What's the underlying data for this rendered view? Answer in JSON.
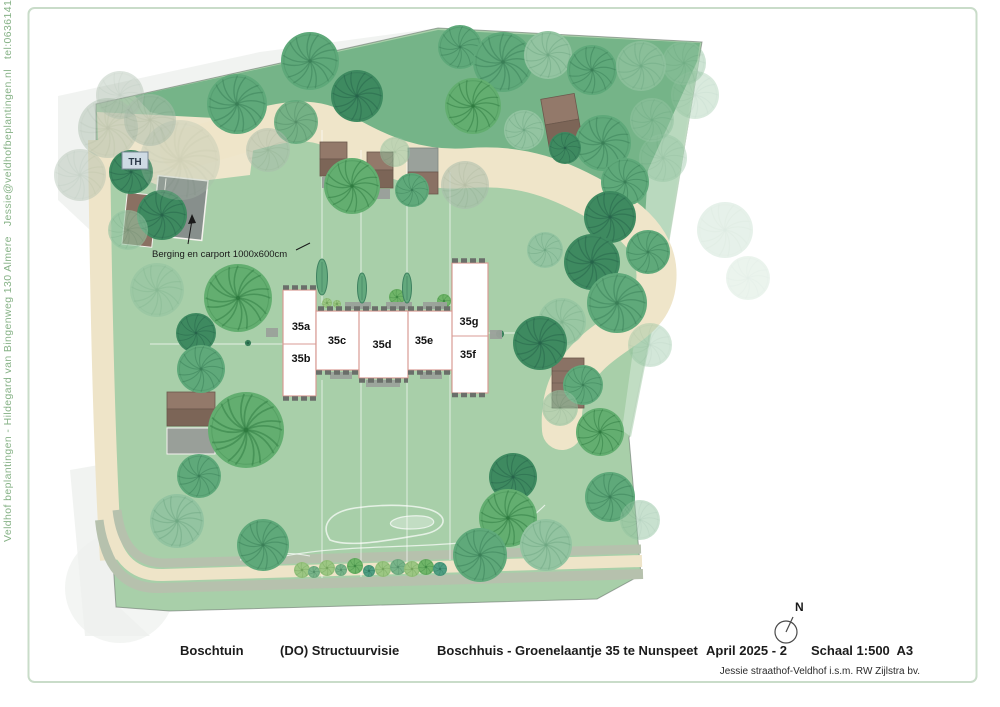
{
  "page": {
    "frame_color": "#c9dcc9",
    "background": "#ffffff"
  },
  "sidebar": {
    "text": "Veldhof beplantingen - Hildegard van Bingenweg 130 Almere   Jessie@veldhofbeplantingen.nl   tel:0636141206",
    "color": "#86b286"
  },
  "footer": {
    "project": "Boschtuin",
    "phase": "(DO) Structuurvisie",
    "title": "Boschhuis - Groenelaantje 35 te Nunspeet",
    "date": "April 2025 - 2",
    "scale": "Schaal 1:500  A3",
    "credit": "Jessie straathof-Veldhof i.s.m. RW Zijlstra bv."
  },
  "compass": {
    "label": "N"
  },
  "map": {
    "annotations": {
      "th_label": "TH",
      "berging_label": "Berging en carport 1000x600cm"
    },
    "colors": {
      "lawn": "#a8cfa9",
      "dark_band": "#75b488",
      "path_beige": "#efe5c9",
      "band_sage": "#b6c1ad",
      "house_outline": "#d89b94",
      "hedge": "#6a6f6a",
      "roof_light": "#93796a",
      "roof_dark": "#7c6557",
      "shed_gray": "#9aa19b"
    },
    "tree_palette": {
      "dark": {
        "f": "#3e8a60",
        "v": "#26644a"
      },
      "mid": {
        "f": "#5fa97a",
        "v": "#3a7f57"
      },
      "bright": {
        "f": "#63ae70",
        "v": "#2e7a3f"
      },
      "pale": {
        "f": "#93c4a1",
        "v": "#6fa883"
      },
      "gray": {
        "f": "#a9bcab",
        "v": "#8aa18c"
      },
      "shrubA": {
        "f": "#9cc783",
        "v": "#74a45d"
      },
      "shrubB": {
        "f": "#78b489",
        "v": "#54906a"
      },
      "shrubC": {
        "f": "#6fb568",
        "v": "#3f8a43"
      },
      "shrubD": {
        "f": "#4f9e82",
        "v": "#2f7a60"
      }
    },
    "trees": [
      [
        108,
        128,
        30,
        "gray",
        0.45
      ],
      [
        80,
        175,
        26,
        "gray",
        0.4
      ],
      [
        120,
        95,
        24,
        "gray",
        0.4
      ],
      [
        150,
        120,
        26,
        "gray",
        0.5
      ],
      [
        695,
        95,
        24,
        "pale",
        0.35
      ],
      [
        725,
        230,
        28,
        "pale",
        0.22
      ],
      [
        748,
        278,
        22,
        "pale",
        0.18
      ],
      [
        663,
        158,
        24,
        "pale",
        0.4
      ],
      [
        684,
        63,
        22,
        "pale",
        0.45
      ],
      [
        652,
        120,
        22,
        "pale",
        0.55
      ],
      [
        650,
        345,
        22,
        "pale",
        0.4
      ],
      [
        237,
        104,
        30,
        "mid",
        1
      ],
      [
        310,
        61,
        29,
        "mid",
        1
      ],
      [
        296,
        122,
        22,
        "mid",
        0.85
      ],
      [
        357,
        96,
        26,
        "dark",
        1
      ],
      [
        460,
        47,
        22,
        "mid",
        1
      ],
      [
        503,
        62,
        30,
        "mid",
        1
      ],
      [
        548,
        55,
        24,
        "pale",
        1
      ],
      [
        592,
        70,
        25,
        "mid",
        1
      ],
      [
        641,
        66,
        25,
        "pale",
        0.7
      ],
      [
        473,
        106,
        28,
        "bright",
        1
      ],
      [
        524,
        130,
        20,
        "pale",
        1
      ],
      [
        603,
        143,
        28,
        "mid",
        1
      ],
      [
        565,
        148,
        16,
        "dark",
        1
      ],
      [
        625,
        182,
        24,
        "mid",
        1
      ],
      [
        268,
        150,
        22,
        "gray",
        0.5
      ],
      [
        352,
        186,
        28,
        "bright",
        1
      ],
      [
        412,
        190,
        17,
        "mid",
        1
      ],
      [
        465,
        185,
        24,
        "gray",
        0.55
      ],
      [
        395,
        152,
        15,
        "pale",
        0.5
      ],
      [
        610,
        217,
        26,
        "dark",
        1
      ],
      [
        648,
        252,
        22,
        "mid",
        1
      ],
      [
        592,
        262,
        28,
        "dark",
        1
      ],
      [
        545,
        250,
        18,
        "pale",
        1
      ],
      [
        617,
        303,
        30,
        "mid",
        1
      ],
      [
        562,
        322,
        24,
        "pale",
        0.7
      ],
      [
        540,
        343,
        27,
        "dark",
        1
      ],
      [
        583,
        385,
        20,
        "mid",
        1
      ],
      [
        131,
        172,
        22,
        "dark",
        1
      ],
      [
        162,
        215,
        25,
        "dark",
        1
      ],
      [
        128,
        230,
        20,
        "pale",
        0.6
      ],
      [
        157,
        290,
        27,
        "pale",
        0.55
      ],
      [
        196,
        333,
        20,
        "dark",
        1
      ],
      [
        201,
        369,
        24,
        "mid",
        1
      ],
      [
        238,
        298,
        34,
        "bright",
        1
      ],
      [
        180,
        160,
        40,
        "gray",
        0.3
      ],
      [
        246,
        430,
        38,
        "bright",
        1
      ],
      [
        199,
        476,
        22,
        "mid",
        1
      ],
      [
        177,
        521,
        27,
        "pale",
        1
      ],
      [
        263,
        545,
        26,
        "mid",
        1
      ],
      [
        513,
        477,
        24,
        "dark",
        1
      ],
      [
        508,
        518,
        29,
        "bright",
        1
      ],
      [
        480,
        555,
        27,
        "mid",
        1
      ],
      [
        546,
        545,
        26,
        "pale",
        1
      ],
      [
        610,
        497,
        25,
        "mid",
        1
      ],
      [
        640,
        520,
        20,
        "pale",
        0.5
      ],
      [
        600,
        432,
        24,
        "bright",
        1
      ],
      [
        560,
        408,
        18,
        "pale",
        0.6
      ],
      [
        302,
        570,
        8,
        "shrubA",
        1
      ],
      [
        314,
        572,
        6,
        "shrubB",
        1
      ],
      [
        327,
        568,
        8,
        "shrubA",
        1
      ],
      [
        341,
        570,
        6,
        "shrubB",
        1
      ],
      [
        355,
        566,
        8,
        "shrubC",
        1
      ],
      [
        369,
        571,
        6,
        "shrubD",
        1
      ],
      [
        383,
        569,
        8,
        "shrubA",
        1
      ],
      [
        398,
        567,
        8,
        "shrubB",
        1
      ],
      [
        412,
        569,
        8,
        "shrubA",
        1
      ],
      [
        426,
        567,
        8,
        "shrubC",
        1
      ],
      [
        440,
        569,
        7,
        "shrubD",
        1
      ],
      [
        397,
        297,
        8,
        "shrubC",
        1
      ],
      [
        444,
        301,
        7,
        "shrubC",
        1
      ],
      [
        327,
        303,
        5,
        "shrubA",
        1
      ],
      [
        337,
        304,
        4,
        "shrubA",
        1
      ],
      [
        248,
        343,
        3,
        "dark",
        1
      ],
      [
        500,
        334,
        4,
        "dark",
        1
      ]
    ],
    "conifers": [
      [
        322,
        277,
        11,
        36
      ],
      [
        362,
        288,
        9,
        30
      ],
      [
        407,
        288,
        9,
        30
      ]
    ],
    "house_units": [
      {
        "id": "35a",
        "x": 301,
        "y": 330
      },
      {
        "id": "35b",
        "x": 301,
        "y": 362
      },
      {
        "id": "35c",
        "x": 337,
        "y": 344
      },
      {
        "id": "35d",
        "x": 382,
        "y": 348
      },
      {
        "id": "35e",
        "x": 424,
        "y": 344
      },
      {
        "id": "35g",
        "x": 469,
        "y": 325
      },
      {
        "id": "35f",
        "x": 468,
        "y": 358
      }
    ]
  }
}
